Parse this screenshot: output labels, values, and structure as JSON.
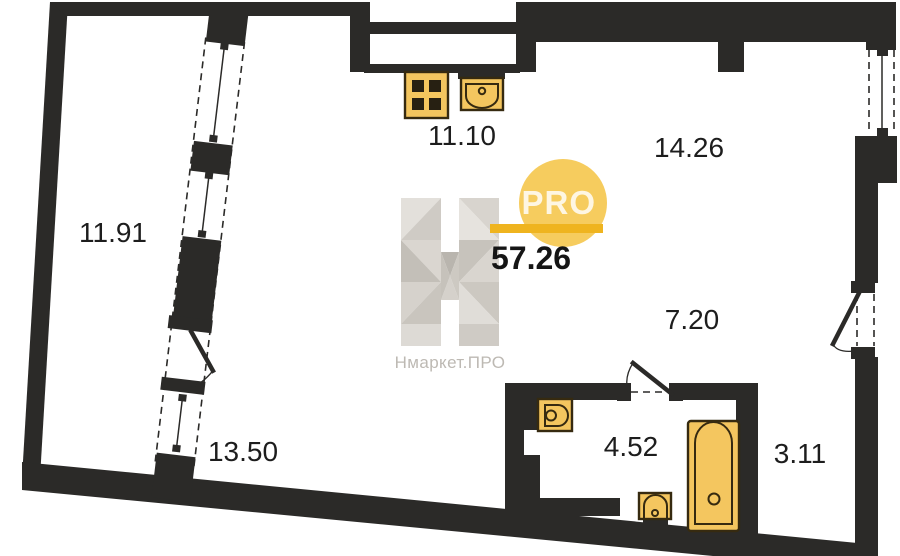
{
  "floorplan": {
    "total_area": "57.26",
    "rooms": [
      {
        "id": "balcony",
        "area": "11.91"
      },
      {
        "id": "kitchen",
        "area": "11.10"
      },
      {
        "id": "living",
        "area": "14.26"
      },
      {
        "id": "hallway",
        "area": "7.20"
      },
      {
        "id": "room-lower",
        "area": "13.50"
      },
      {
        "id": "bathroom",
        "area": "4.52"
      },
      {
        "id": "closet",
        "area": "3.11"
      }
    ],
    "fixtures": [
      "stove-icon",
      "kitchen-sink-icon",
      "bathroom-sink-icon",
      "toilet-icon",
      "bathtub-icon"
    ],
    "colors": {
      "wall": "#2b2a28",
      "fixture_fill": "#f4c65f",
      "fixture_outline": "#362a10",
      "burner": "#272012",
      "logo_circle": "#f6cc5e",
      "logo_bar": "#efb41f",
      "logo_gray": "#bdb9b3",
      "label": "#1d1d1d"
    }
  },
  "watermark": {
    "badge": "PRO",
    "brand": "Нмаркет.ПРО"
  }
}
